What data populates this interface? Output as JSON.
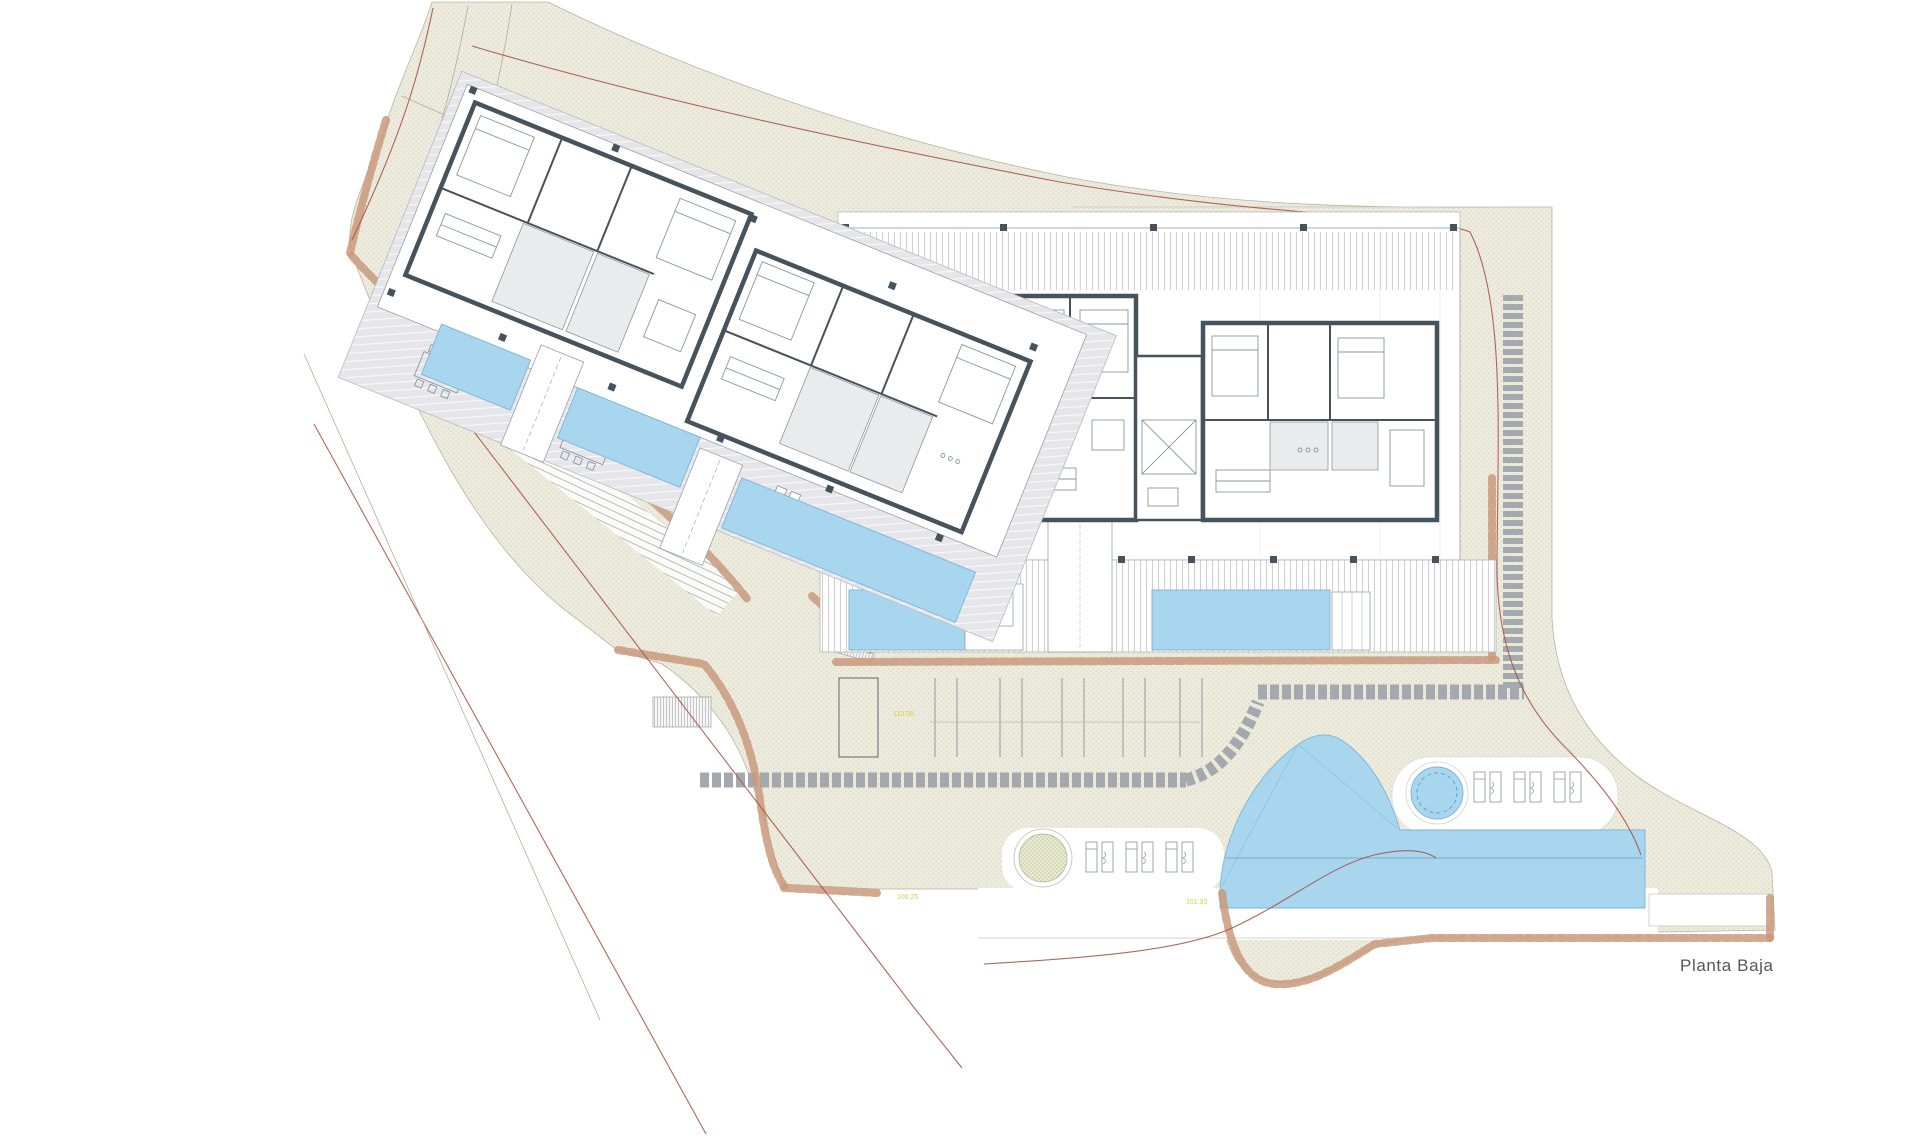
{
  "plan": {
    "title": "Planta Baja",
    "level_marks": [
      "110.05",
      "100.25",
      "101.33"
    ],
    "colors": {
      "site_fill": "#edebdd",
      "water_blue": "#a8d6ef",
      "wall_dark": "#46525c",
      "boundary_red": "#a6574d",
      "stone_wall_brown": "#c89a7c",
      "stepping_stone_gray": "#a4a9ad",
      "label_yellow": "#d6cf4a",
      "planter_green": "#b9c48e"
    },
    "features": {
      "left_building": "rotated apartment block with terraces and pools",
      "right_building": "apartment block with terraces and pools",
      "main_pool": "free-form swimming pool",
      "spa": "circular spa",
      "parking": "parking stalls",
      "path": "stepping stone path",
      "walls": "rubble stone retaining walls"
    }
  }
}
